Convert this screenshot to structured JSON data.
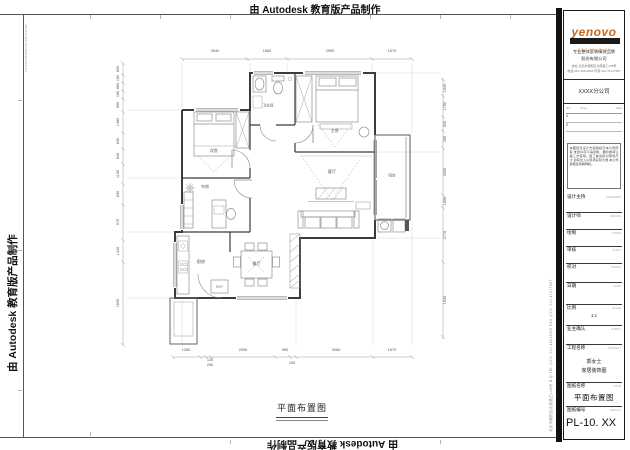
{
  "edu_banner": "由 Autodesk 教育版产品制作",
  "plan": {
    "caption": "平面布置图",
    "rooms": {
      "bedroom2": "次卧",
      "study": "书房",
      "kitchen": "厨房",
      "dining": "餐厅",
      "living": "客厅",
      "master": "主卧",
      "bath": "卫生间",
      "balcony": "阳台"
    },
    "ref_label": "REF",
    "dims": {
      "top": [
        "3040",
        "1660",
        "2990",
        "1570"
      ],
      "bottom": [
        "1280",
        "2930",
        "990",
        "3060",
        "1570"
      ],
      "bottom_sub": [
        "120",
        "250",
        "100"
      ],
      "left": [
        "600",
        "150",
        "660",
        "150",
        "650",
        "1480",
        "630",
        "640",
        "1100",
        "630",
        "970",
        "1440",
        "1830"
      ],
      "right": [
        "1040",
        "1790",
        "940",
        "400",
        "2000",
        "1090",
        "2770",
        "1930"
      ]
    }
  },
  "side_contact": "北京市朝阳区北苑路乙108号  B.Q  TEL (010) 010 44513506  FAX (010) 010 47217587",
  "inner_margin_note": "TEL (010) 44513506  FAX (010) 47217587",
  "title_block": {
    "brand": "yenovo",
    "brand_sub": "DECORATION",
    "company_line1": "专业整体家装精装品牌",
    "company_line2": "股份有限公司",
    "address_line1": "地址:北京市朝阳区北苑路乙108号",
    "address_line2": "电话:010-44513506 传真:010-47217587",
    "branch": "XXXX分公司",
    "issue": {
      "no": "NO.",
      "issue": "Issue",
      "date": "Date",
      "rows": [
        "A",
        "B"
      ]
    },
    "notice": "本图纸及设计方案版权归本公司所有,未经许可不得复制、翻印或转让第三方使用。施工前请核对现场尺寸,如有出入以现场实际为准,本公司保留最终解释权。",
    "fields": [
      {
        "label": "设计主持",
        "en": "DESIGNED",
        "value": ""
      },
      {
        "label": "设计师",
        "en": "DESIGN",
        "value": ""
      },
      {
        "label": "绘制",
        "en": "DRAW",
        "value": ""
      },
      {
        "label": "审核",
        "en": "AUDIT",
        "value": ""
      },
      {
        "label": "校对",
        "en": "PROOF",
        "value": ""
      },
      {
        "label": "日期",
        "en": "DATE",
        "value": ""
      },
      {
        "label": "比例",
        "en": "SCALE",
        "value": "1:1"
      },
      {
        "label": "业主确认",
        "en": "CLIENT",
        "value": ""
      }
    ],
    "project": {
      "label": "工程名称",
      "en": "PROJECT",
      "line1": "郭女士",
      "line2": "家居装饰图"
    },
    "sheet": {
      "label": "图纸名称",
      "en": "TITLE",
      "value": "平面布置图"
    },
    "number": {
      "label": "图纸编号",
      "en": "DWG.No",
      "value": "PL-10. XX"
    }
  },
  "colors": {
    "accent": "#c96a1e",
    "line": "#3b3b3b"
  }
}
